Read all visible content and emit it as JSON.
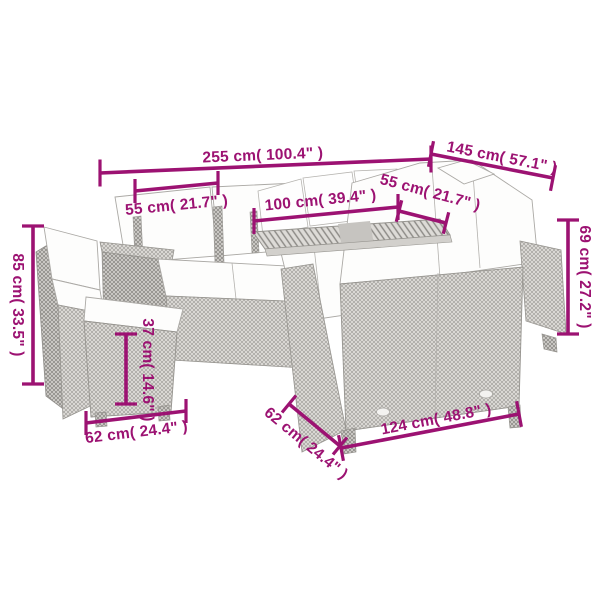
{
  "colors": {
    "accent": "#9C1272",
    "sketch": "#a8a6a2",
    "background": "#ffffff"
  },
  "product": {
    "type": "garden-lounge-set-dimension-diagram"
  },
  "dimensions": {
    "overall_width": {
      "cm": 255,
      "inches": 100.4,
      "label": "255 cm( 100.4\" )"
    },
    "right_section_width": {
      "cm": 145,
      "inches": 57.1,
      "label": "145 cm( 57.1\" )"
    },
    "left_seat_width": {
      "cm": 55,
      "inches": 21.7,
      "label": "55 cm( 21.7\" )"
    },
    "table_width": {
      "cm": 100,
      "inches": 39.4,
      "label": "100 cm( 39.4\" )"
    },
    "right_seat_width": {
      "cm": 55,
      "inches": 21.7,
      "label": "55 cm( 21.7\" )"
    },
    "back_height": {
      "cm": 85,
      "inches": 33.5,
      "label": "85 cm( 33.5\" )"
    },
    "arm_height": {
      "cm": 69,
      "inches": 27.2,
      "label": "69 cm( 27.2\" )"
    },
    "ottoman_height": {
      "cm": 37,
      "inches": 14.6,
      "label": "37 cm( 14.6\" )"
    },
    "ottoman_width": {
      "cm": 62,
      "inches": 24.4,
      "label": "62 cm( 24.4\" )"
    },
    "sofa_depth": {
      "cm": 62,
      "inches": 24.4,
      "label": "62 cm( 24.4\" )"
    },
    "sofa_width": {
      "cm": 124,
      "inches": 48.8,
      "label": "124 cm( 48.8\" )"
    }
  }
}
